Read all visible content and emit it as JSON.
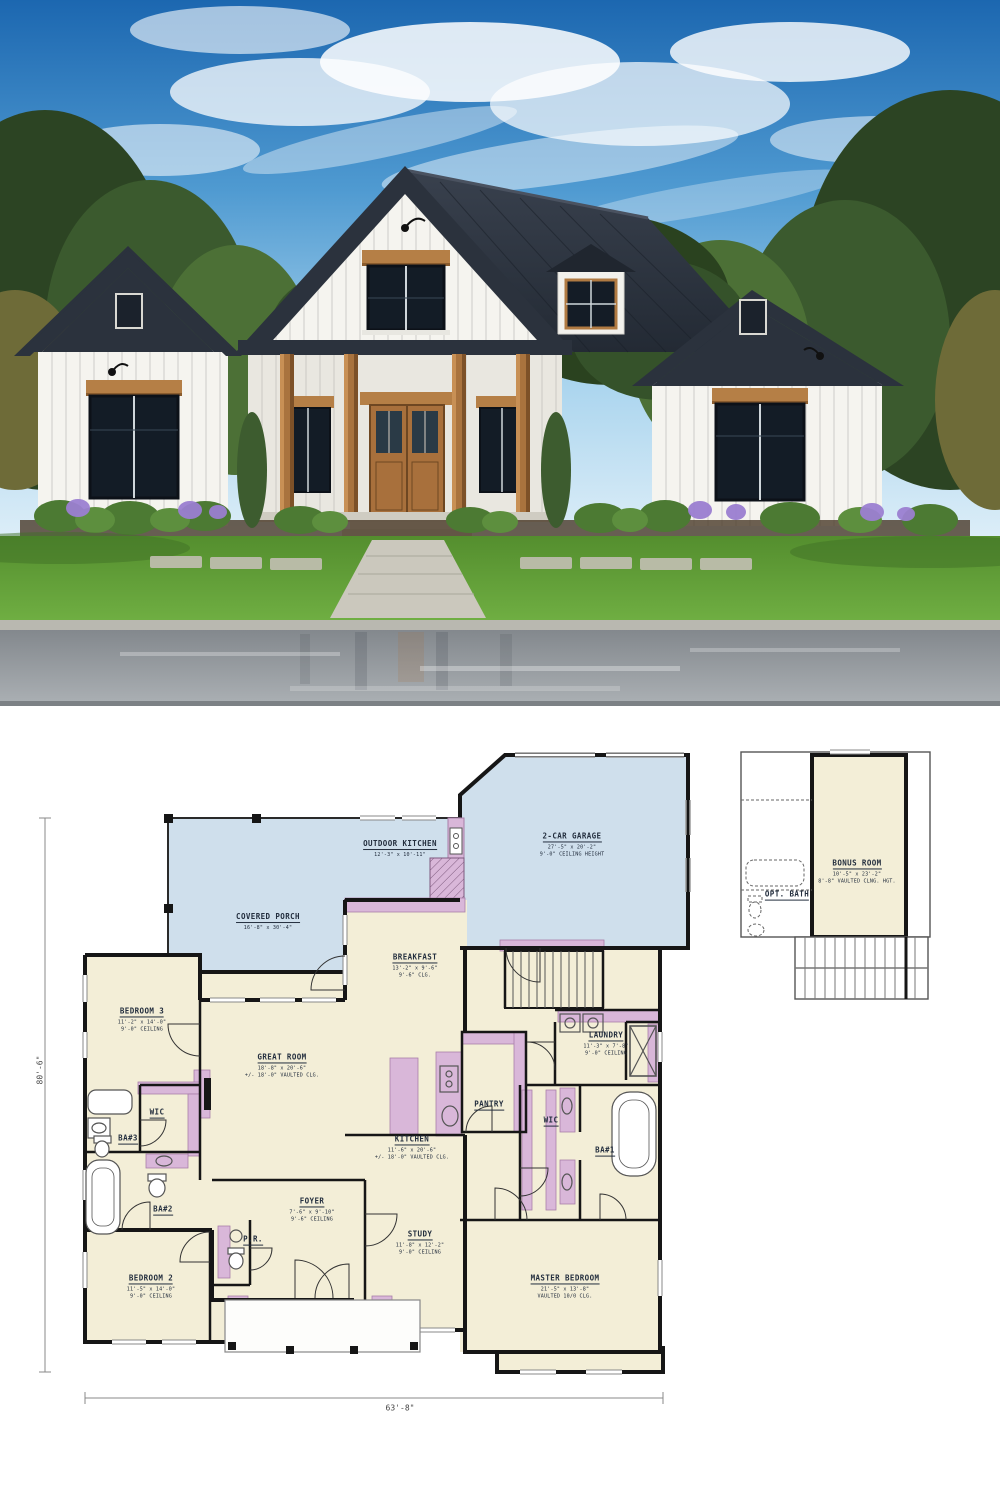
{
  "meta": {
    "description": "Modern farmhouse exterior rendering above its first-floor plan"
  },
  "palette": {
    "plan_room_fill": "#f3eed7",
    "plan_porch_fill": "#cfdfec",
    "plan_accent_fill": "#d9b7d9",
    "plan_wall": "#161616",
    "roof": "#2b323d",
    "siding": "#f5f4ef",
    "wood_trim": "#b07a42",
    "sky": "#2a77bd",
    "lawn": "#5d9633"
  },
  "floor_plan": {
    "rooms": [
      {
        "id": "outdoor_kitchen",
        "name": "OUTDOOR KITCHEN",
        "dim1": "12'-3\" x 10'-11\"",
        "dim2": ""
      },
      {
        "id": "garage",
        "name": "2-CAR GARAGE",
        "dim1": "27'-5\" x 20'-2\"",
        "dim2": "9'-0\" CEILING HEIGHT"
      },
      {
        "id": "covered_porch",
        "name": "COVERED PORCH",
        "dim1": "16'-8\" x 30'-4\"",
        "dim2": ""
      },
      {
        "id": "breakfast",
        "name": "BREAKFAST",
        "dim1": "13'-2\" x 9'-6\"",
        "dim2": "9'-6\" CLG."
      },
      {
        "id": "bedroom3",
        "name": "BEDROOM 3",
        "dim1": "11'-2\" x 14'-0\"",
        "dim2": "9'-0\" CEILING"
      },
      {
        "id": "great_room",
        "name": "GREAT ROOM",
        "dim1": "18'-8\" x 20'-6\"",
        "dim2": "+/- 18'-0\" VAULTED CLG."
      },
      {
        "id": "laundry",
        "name": "LAUNDRY",
        "dim1": "11'-3\" x 7'-8\"",
        "dim2": "9'-0\" CEILING"
      },
      {
        "id": "wic_left",
        "name": "WIC",
        "dim1": "",
        "dim2": ""
      },
      {
        "id": "ba3",
        "name": "BA#3",
        "dim1": "",
        "dim2": ""
      },
      {
        "id": "ba2",
        "name": "BA#2",
        "dim1": "",
        "dim2": ""
      },
      {
        "id": "pantry",
        "name": "PANTRY",
        "dim1": "",
        "dim2": ""
      },
      {
        "id": "kitchen",
        "name": "KITCHEN",
        "dim1": "11'-6\" x 20'-6\"",
        "dim2": "+/- 18'-0\" VAULTED CLG."
      },
      {
        "id": "wic_right",
        "name": "WIC",
        "dim1": "",
        "dim2": ""
      },
      {
        "id": "ba1",
        "name": "BA#1",
        "dim1": "",
        "dim2": ""
      },
      {
        "id": "foyer",
        "name": "FOYER",
        "dim1": "7'-6\" x 9'-10\"",
        "dim2": "9'-6\" CEILING"
      },
      {
        "id": "pr",
        "name": "P.R.",
        "dim1": "",
        "dim2": ""
      },
      {
        "id": "study",
        "name": "STUDY",
        "dim1": "11'-8\" x 12'-2\"",
        "dim2": "9'-0\" CEILING"
      },
      {
        "id": "bedroom2",
        "name": "BEDROOM 2",
        "dim1": "11'-5\" x 14'-0\"",
        "dim2": "9'-0\" CEILING"
      },
      {
        "id": "master",
        "name": "MASTER BEDROOM",
        "dim1": "21'-5\" x 13'-8\"",
        "dim2": "VAULTED 10/0 CLG."
      },
      {
        "id": "bonus",
        "name": "BONUS ROOM",
        "dim1": "10'-5\" x 23'-2\"",
        "dim2": "8'-8\" VAULTED CLNG. HGT."
      },
      {
        "id": "opt_bath",
        "name": "OPT. BATH",
        "dim1": "",
        "dim2": ""
      }
    ],
    "dimensions": {
      "width_label": "63'-8\"",
      "height_label": "80'-6\""
    }
  }
}
